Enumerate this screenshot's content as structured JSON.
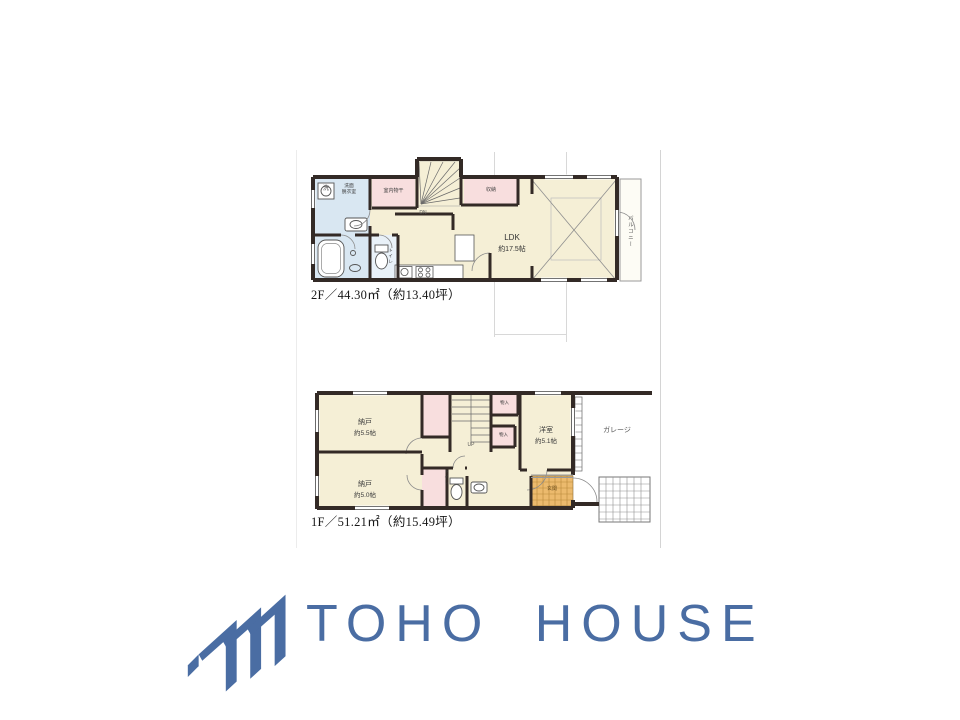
{
  "floorplan": {
    "floor2": {
      "area_label": "2F／44.30㎡（約13.40坪）",
      "rooms": {
        "ldk_name": "LDK",
        "ldk_size": "約17.5帖",
        "washroom_line1": "洗面",
        "washroom_line2": "脱衣室",
        "wash_symbol": "洗",
        "drying_room": "室内物干",
        "closet": "収納",
        "toilet": "トイレ",
        "balcony": "バルコニー",
        "stairs_direction": "DN"
      }
    },
    "floor1": {
      "area_label": "1F／51.21㎡（約15.49坪）",
      "rooms": {
        "storage1_name": "納戸",
        "storage1_size": "約5.5帖",
        "storage2_name": "納戸",
        "storage2_size": "約5.0帖",
        "western_name": "洋室",
        "western_size": "約5.1帖",
        "garage": "ガレージ",
        "entrance": "玄関",
        "toilet": "トイレ",
        "closet_a": "物入",
        "closet_b": "物入",
        "stairs_direction": "UP"
      }
    }
  },
  "logo": {
    "text": "TOHO HOUSE",
    "brand_color": "#4a6da3",
    "icon": "three-roof-chevrons"
  },
  "palette": {
    "wall": "#332a26",
    "room_cream": "#f5efd6",
    "wet_blue": "#d9e7f2",
    "closet_pink": "#f8dede",
    "entrance_tile_orange": "#ecba6d"
  }
}
